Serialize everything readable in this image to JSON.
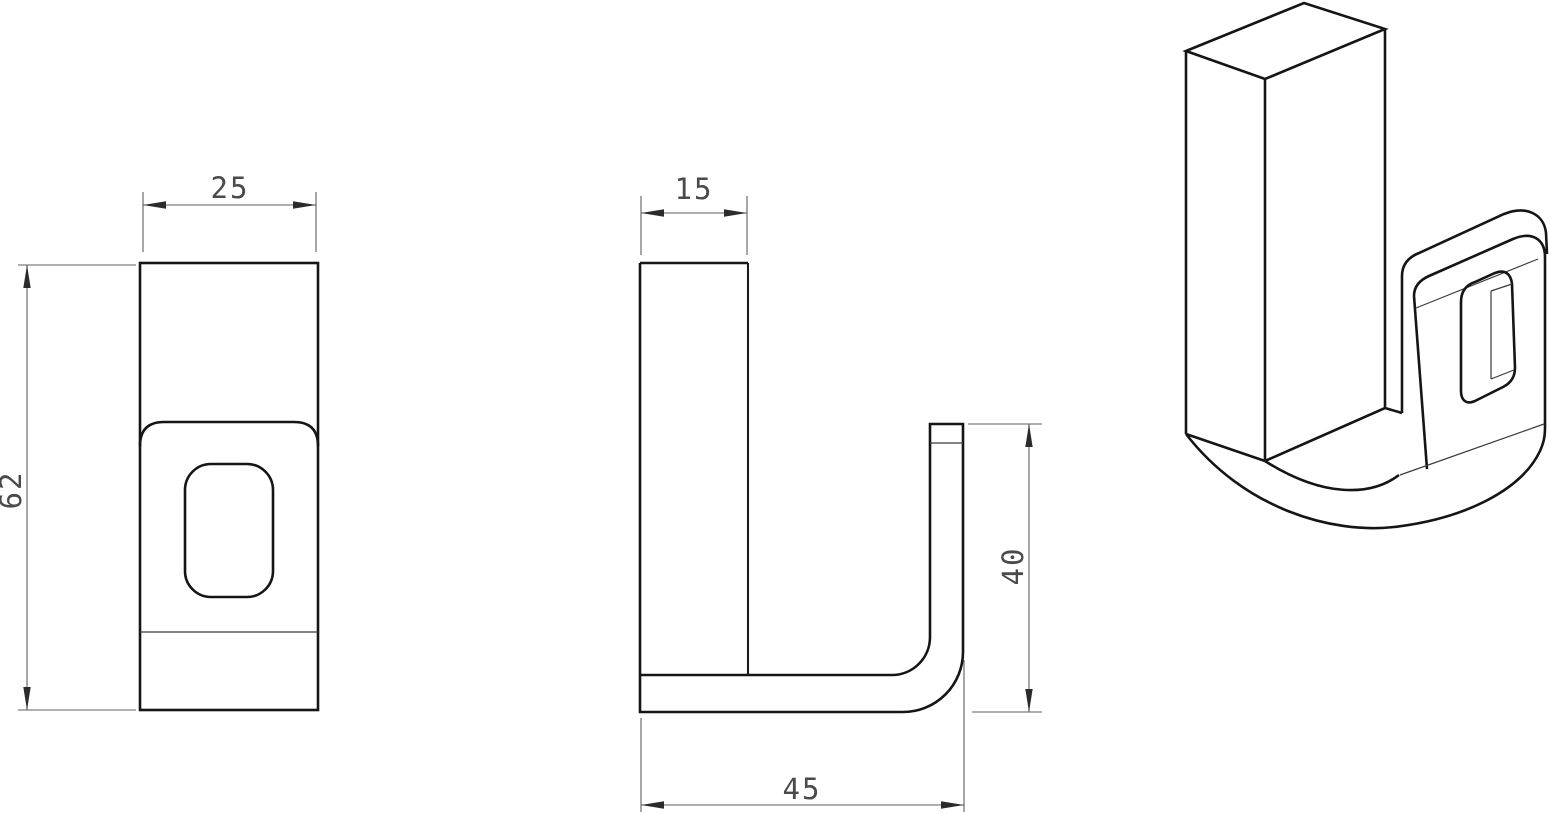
{
  "page": {
    "background": "#ffffff",
    "part_line_color": "#151515",
    "dimension_line_color": "#5f5f5f",
    "dimension_text_color": "#4a4a4a"
  },
  "views": {
    "front": {
      "dimensions": {
        "width": "25",
        "height": "62"
      }
    },
    "side": {
      "dimensions": {
        "width": "15",
        "hook_height": "40",
        "base_length": "45"
      }
    },
    "isometric": {}
  }
}
